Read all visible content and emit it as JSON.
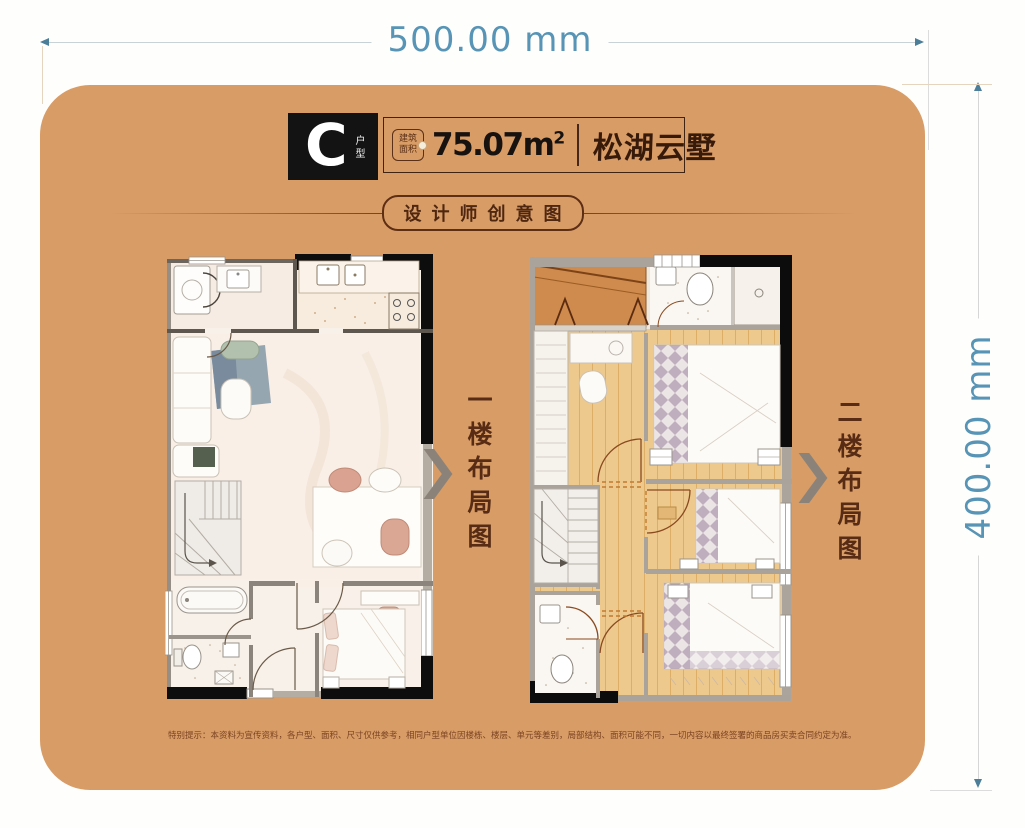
{
  "dimensions": {
    "width_label": "500.00 mm",
    "height_label": "400.00 mm"
  },
  "header": {
    "unit_letter": "C",
    "unit_type_label": "户型",
    "area_badge_line1": "建筑",
    "area_badge_line2": "面积",
    "area_value": "75.07",
    "area_unit": "m",
    "area_exponent": "2",
    "brand_name": "松湖云墅"
  },
  "subtitle": {
    "label": "设计师创意图"
  },
  "plans": {
    "first_label": "一楼布局图",
    "second_label": "二楼布局图"
  },
  "footer": {
    "disclaimer": "特别提示：本资料为宣传资料，各户型、面积、尺寸仅供参考，相同户型单位因楼栋、楼层、单元等差别，局部结构、面积可能不同，一切内容以最终签署的商品房买卖合同约定为准。"
  },
  "colors": {
    "card_background": "#d89c66",
    "dimension_text": "#5794b5",
    "ink_dark_brown": "#4f2710",
    "unit_block_background": "#131313",
    "brand_ink": "#381a0a",
    "wood_floor": "#eec98d",
    "terrace_orange": "#cf8a4d"
  }
}
